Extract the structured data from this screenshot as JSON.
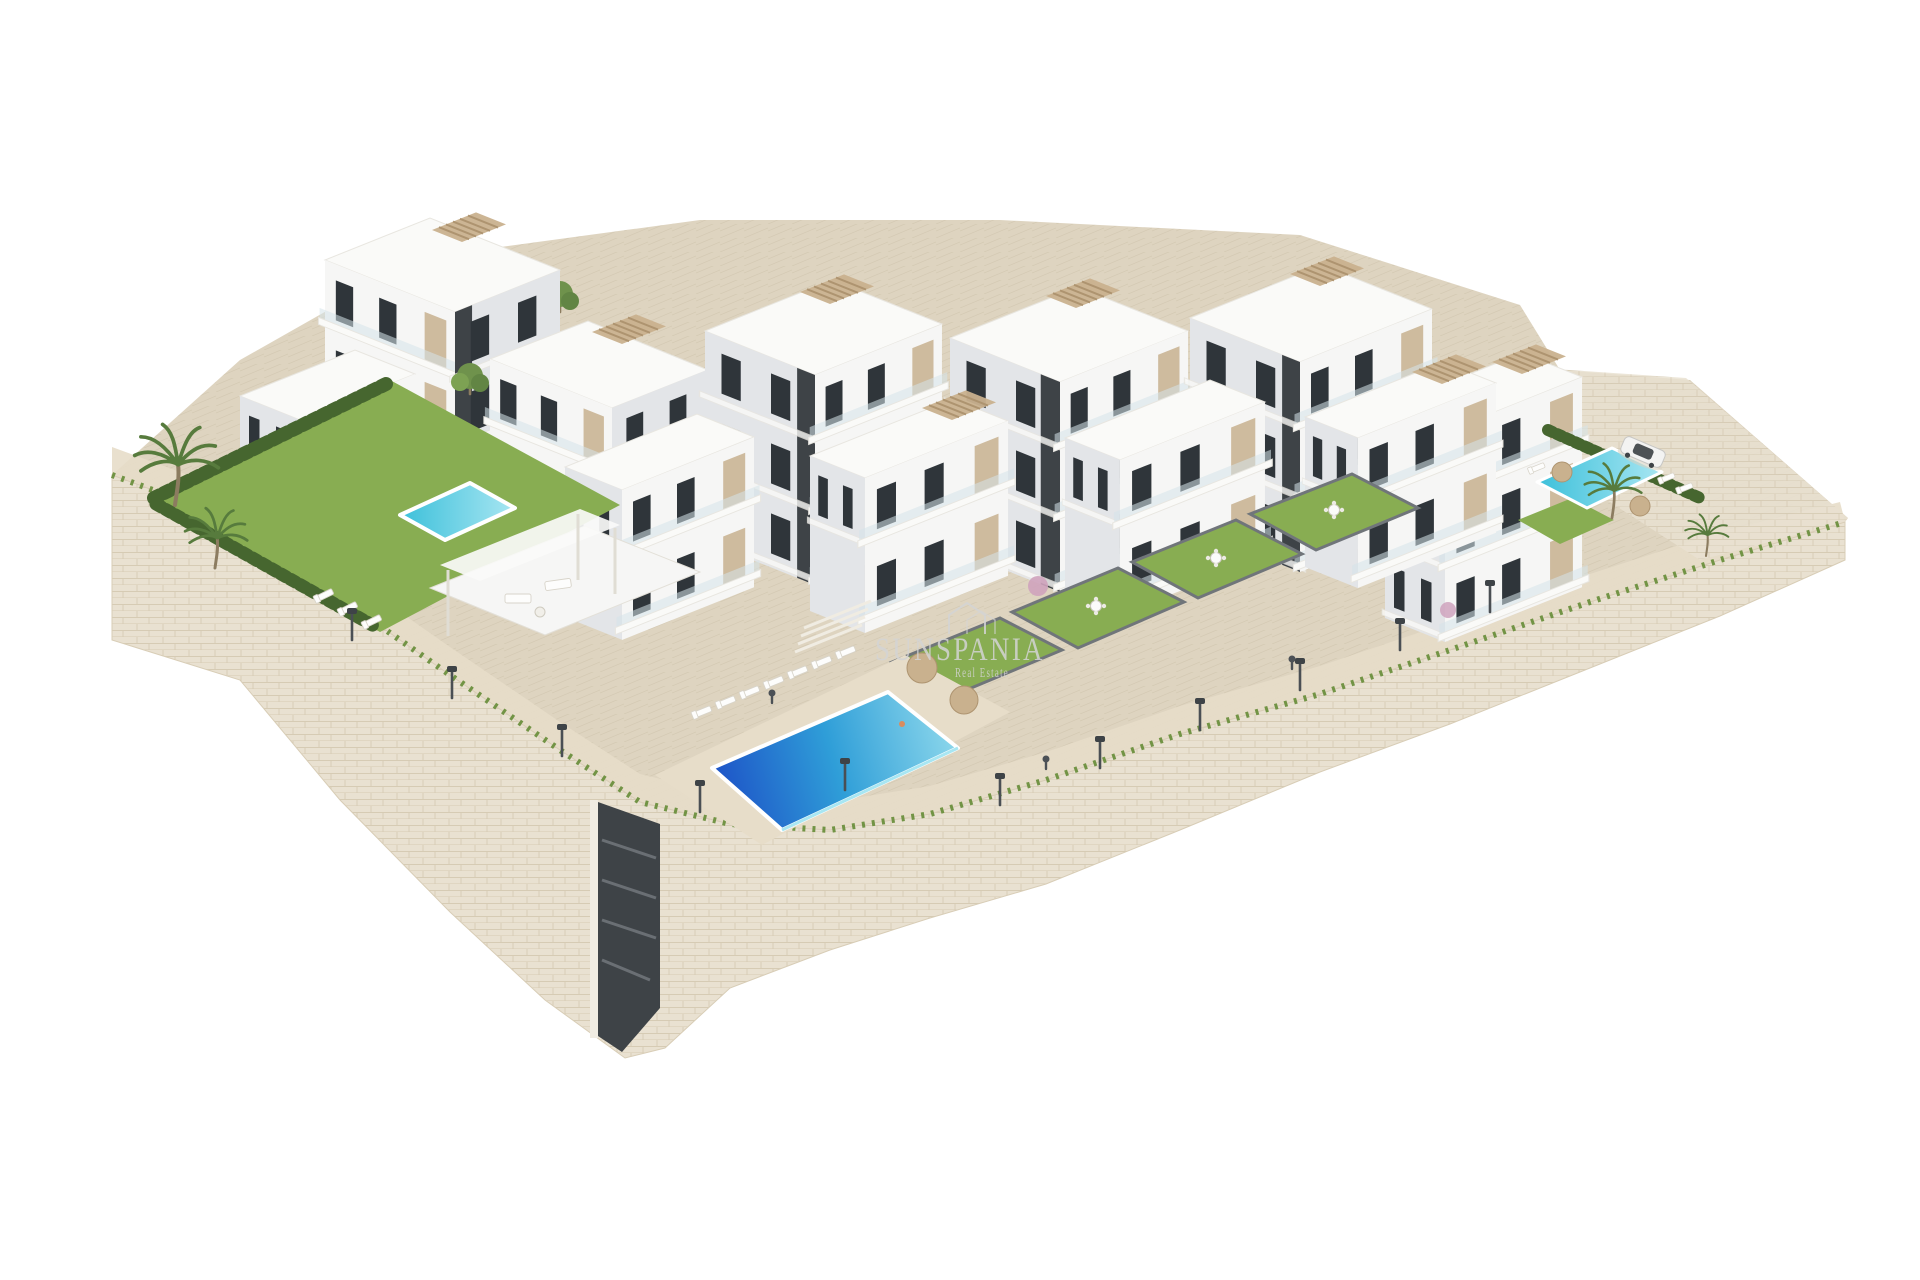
{
  "scene": {
    "description": "Aerial 3D architectural rendering of a modern white residential apartment complex built on a terraced hillside. Six stepped apartment blocks with beige panels, dark glazing, glass balconies and rooftop pergolas stand above landscaped grounds with a large blue infinity swimming pool, two smaller plunge pools, private walled lawn gardens with dining sets, palm trees, cypress hedges, sun loungers, parasols, street lamps, a parked white car, and a tall natural-stone retaining wall curving along the base. Plain white background.",
    "background_color": "#ffffff",
    "render_style": "isometric aerial exterior visualization"
  },
  "watermark": {
    "brand": "SUNSPANIA",
    "tagline": "Real Estate",
    "icon": "house-outline",
    "opacity": "0.85"
  },
  "site": {
    "buildings_count": "6 main blocks + 5 front terrace wings",
    "floors_visible": "3-5",
    "pools": [
      "large central infinity pool",
      "left garden plunge pool",
      "right terrace pool"
    ],
    "landscape": [
      "green lawns",
      "cypress hedges",
      "palm trees",
      "flowering shrubs",
      "stone retaining walls",
      "paved walkways with street lamps"
    ],
    "props": [
      "sun loungers",
      "tan parasols",
      "outdoor dining sets",
      "pergola lounge",
      "parked white car",
      "pedestrians"
    ]
  },
  "palette": {
    "background": "#ffffff",
    "building_white": "#f6f6f5",
    "building_shade": "#e3e5e8",
    "building_roof": "#fafaf8",
    "building_beige": "#cebb9e",
    "accent_dark": "#3e4347",
    "window_glass": "#2f353a",
    "glass_rail": "#d5e4ea",
    "pergola_tan": "#c9b18e",
    "pergola_slat": "#ae9470",
    "stone_fill": "#e9e1d1",
    "stone_line": "#cdbfa5",
    "paving": "#ded4c0",
    "paving_light": "#e7ddc9",
    "paving_line": "#c9bda4",
    "lawn": "#88ad52",
    "lawn_dark": "#6c8f3e",
    "hedge": "#46662f",
    "palm_green": "#577b3d",
    "trunk": "#8c7c60",
    "pool_deep": "#1c4ec6",
    "pool_mid": "#2f9ed8",
    "pool_light": "#8fd9ec",
    "pool_teal": "#3cc0da",
    "pool_teal_light": "#a8e6f2",
    "lamp_dark": "#4a4f54",
    "figure_dark": "#4c5156",
    "flower_pink": "#cfa3bd",
    "car_body": "#f3f3f2",
    "watermark": "#d4d4d4"
  }
}
